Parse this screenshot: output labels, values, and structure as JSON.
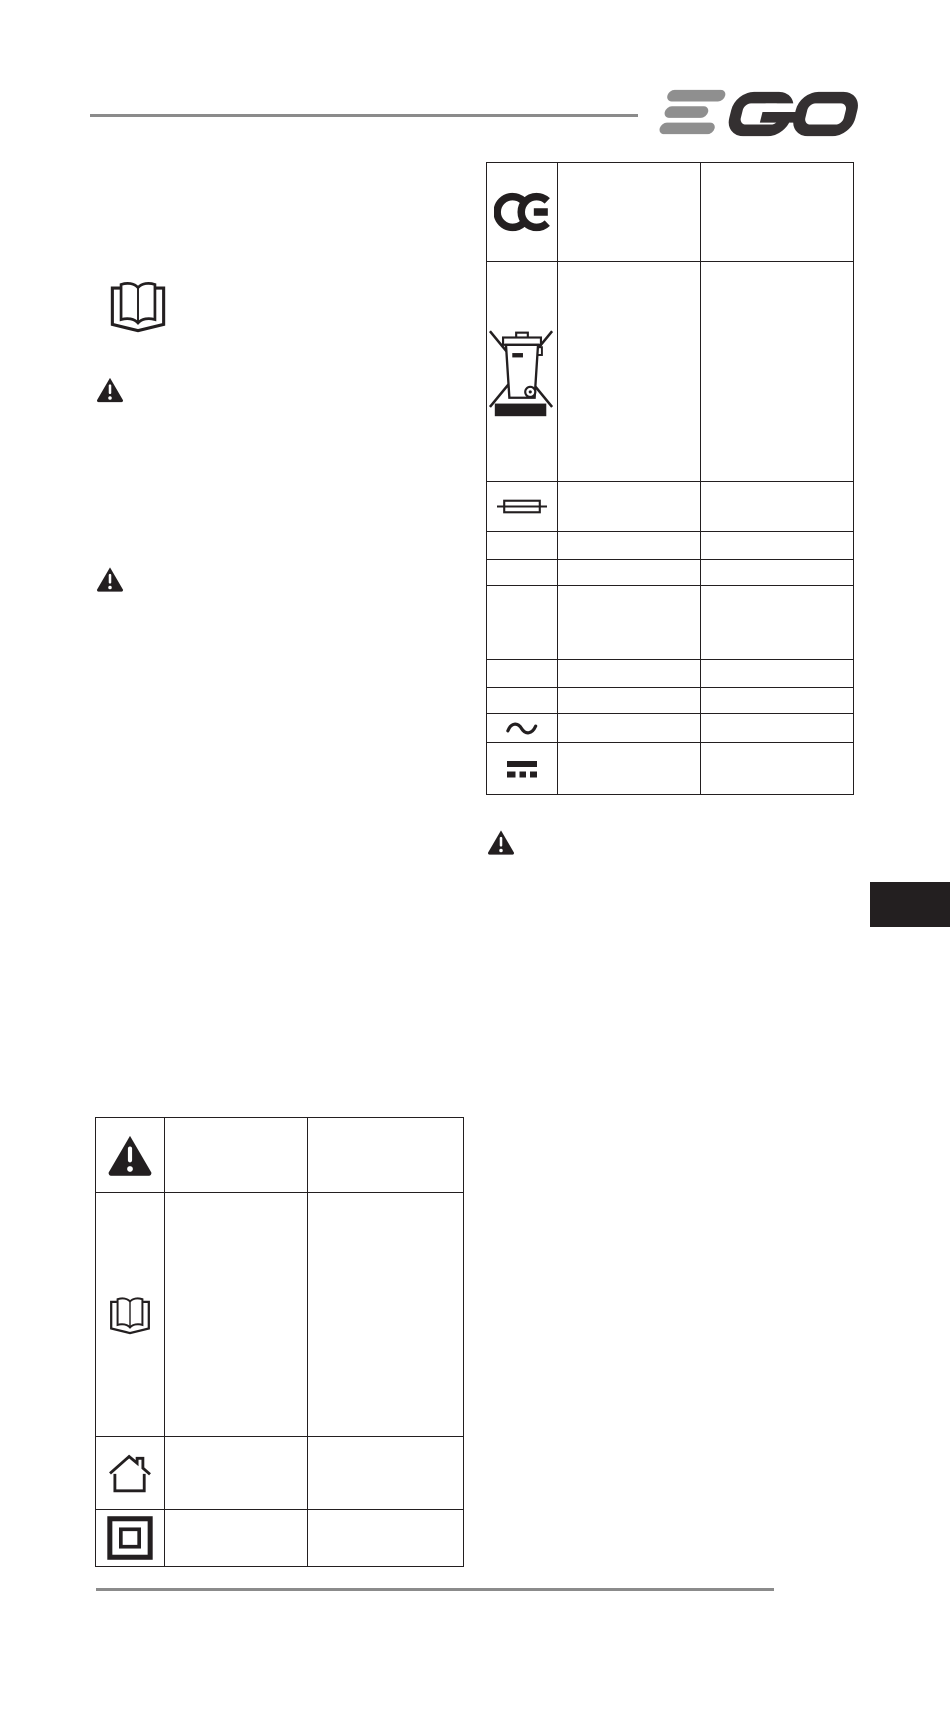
{
  "page": {
    "background": "#ffffff",
    "ink_color": "#231f20",
    "rule_color": "#8b8b8b"
  },
  "header": {
    "brand": "EGO",
    "logo_gray": "#8f8f8f",
    "logo_dark": "#343031"
  },
  "left_column": {
    "read_manual_icon": "open-book-icon",
    "warning_icons": [
      "warning-triangle-icon",
      "warning-triangle-icon"
    ]
  },
  "right_symbol_table": {
    "rows": [
      {
        "symbol": "ce-mark",
        "label": "",
        "description": ""
      },
      {
        "symbol": "weee-crossed-out-wheeled-bin",
        "label": "",
        "description": ""
      },
      {
        "symbol": "fuse",
        "label": "",
        "description": ""
      },
      {
        "symbol": "",
        "label": "",
        "description": ""
      },
      {
        "symbol": "",
        "label": "",
        "description": ""
      },
      {
        "symbol": "",
        "label": "",
        "description": ""
      },
      {
        "symbol": "",
        "label": "",
        "description": ""
      },
      {
        "symbol": "",
        "label": "",
        "description": ""
      },
      {
        "symbol": "alternating-current",
        "label": "",
        "description": ""
      },
      {
        "symbol": "direct-current",
        "label": "",
        "description": ""
      }
    ]
  },
  "standalone_warning": "warning-triangle-icon",
  "bottom_symbol_table": {
    "rows": [
      {
        "symbol": "warning-alert",
        "label": "",
        "description": ""
      },
      {
        "symbol": "read-operators-manual",
        "label": "",
        "description": ""
      },
      {
        "symbol": "house",
        "label": "",
        "description": ""
      },
      {
        "symbol": "class-ii-double-insulated",
        "label": "",
        "description": ""
      }
    ]
  },
  "page_tab": {
    "color": "#231f20"
  }
}
